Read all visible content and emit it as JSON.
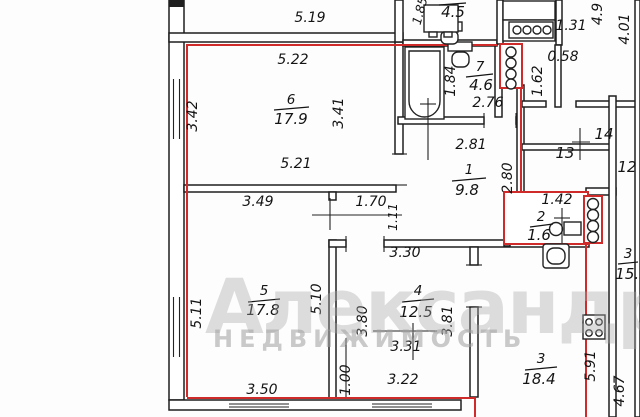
{
  "watermark": {
    "title": "Александр",
    "subtitle": "НЕДВИЖИМОСТЬ"
  },
  "outer": {
    "top_width": "5.19"
  },
  "rooms": {
    "r1": {
      "number": "1",
      "area": "9.8",
      "dims": {
        "top": "2.81",
        "right": "2.80",
        "west": "3.49",
        "corridor_top": "1.70",
        "corridor_width": "1.11"
      }
    },
    "r2": {
      "number": "2",
      "area": "1.6",
      "dims": {
        "top": "1.42"
      }
    },
    "r3": {
      "number": "3",
      "area": "18.4",
      "dims": {
        "right": "5.91",
        "outer_right": "4.67"
      }
    },
    "r4": {
      "number": "4",
      "area": "12.5",
      "dims": {
        "top": "3.30",
        "left": "3.80",
        "right": "3.81",
        "mid": "3.31",
        "bottom": "3.22",
        "bottom_left": "1.00"
      }
    },
    "r5": {
      "number": "5",
      "area": "17.8",
      "dims": {
        "left": "5.11",
        "right": "5.10",
        "bottom": "3.50"
      }
    },
    "r6": {
      "number": "6",
      "area": "17.9",
      "dims": {
        "top": "5.22",
        "left": "3.42",
        "right": "3.41",
        "bottom": "5.21"
      }
    },
    "r7": {
      "number": "7",
      "area": "4.6",
      "dims": {
        "left": "1.84",
        "bottom": "2.76"
      }
    }
  },
  "neighbor": {
    "top_room_area": "4.5",
    "top_left_dim": "1.85",
    "kitchen_dims": {
      "w1": "1.31",
      "w2": "0.58",
      "w3": "1.62",
      "h1": "4.9",
      "h2": "4.01"
    },
    "room_numbers": {
      "r12": "12",
      "r13": "13",
      "r14": "14"
    },
    "edge_room": {
      "number": "3",
      "area": "15.5"
    }
  }
}
